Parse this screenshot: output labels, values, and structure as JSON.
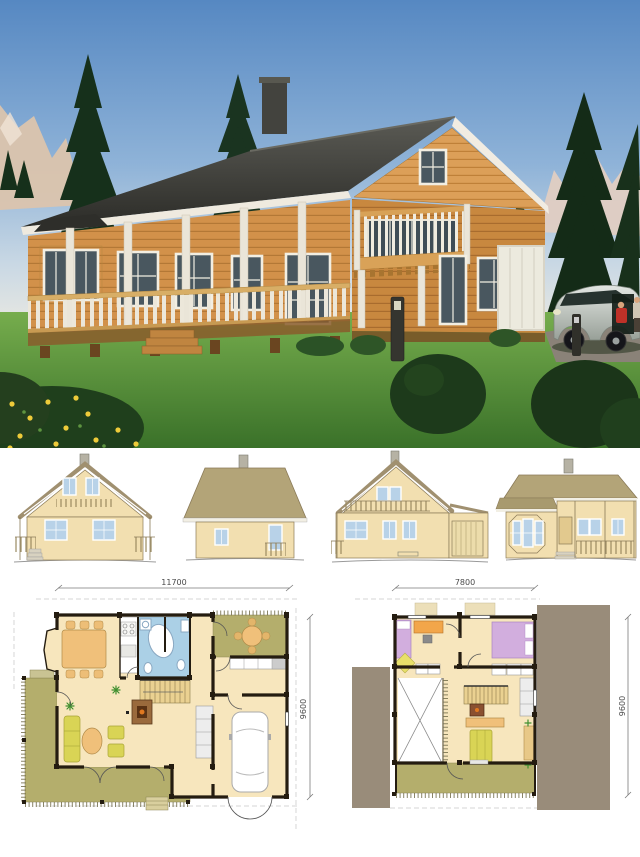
{
  "title": "Log house exterior rendering with elevations and floor plans",
  "dimensions": {
    "ground_floor_width": "11700",
    "upper_floor_width": "7800",
    "ground_floor_depth": "9600",
    "upper_floor_depth": "9600"
  },
  "palette": {
    "plan_floor": "#f7e6bd",
    "plan_deck": "#b4ae6c",
    "plan_bath": "#abd0e6",
    "plan_wall": "#241c10",
    "plan_roof_mask": "#998c7a",
    "bed_lilac": "#d2aede",
    "sofa_yellow": "#d9d455",
    "furniture_tan": "#f0c07a",
    "elevation_wall": "#f2dfb0",
    "elevation_roof": "#b3a478",
    "photo_sky_top": "#5688c2",
    "photo_grass": "#4e8c38",
    "photo_wood_wall": "#d2914a",
    "photo_roof": "#3b3b38"
  }
}
